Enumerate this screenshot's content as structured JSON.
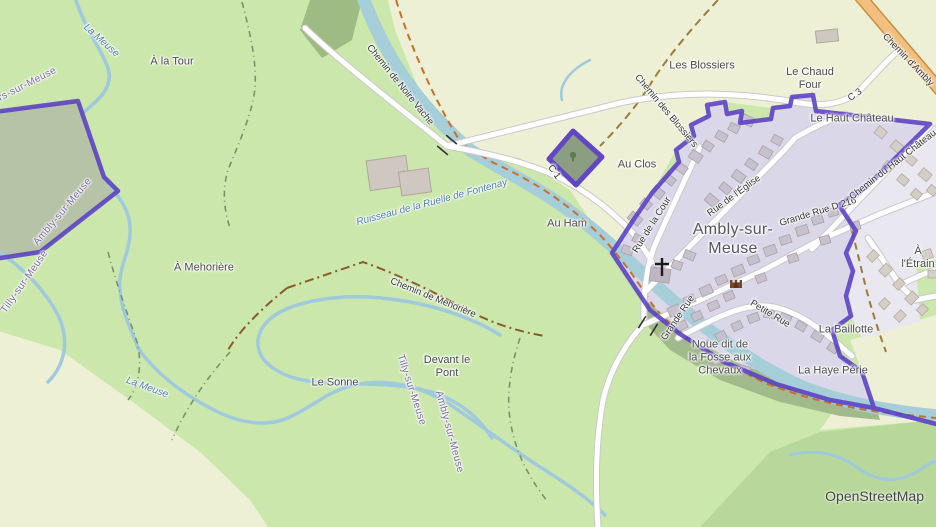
{
  "map": {
    "attribution": "OpenStreetMap",
    "place_labels": {
      "les_blossiers": "Les Blossiers",
      "le_chaud_four": "Le Chaud\nFour",
      "le_haut_chateau": "Le Haut Château",
      "au_clos": "Au Clos",
      "au_ham": "Au Ham",
      "a_la_tour": "À la Tour",
      "a_mehoriere": "À Mehorière",
      "devant_le_pont": "Devant le\nPont",
      "le_sonne": "Le Sonne",
      "la_baillotte": "La Baillotte",
      "la_haye_perie": "La Haye Périe",
      "noue_fosse_chevaux": "Noue dit de\nla Fosse aux\nChevaux",
      "a_l_etrain": "À l'Étrain",
      "village_name": "Ambly-sur-\nMeuse"
    },
    "road_labels": {
      "chemin_de_noire_vache": "Chemin de Noire Vache",
      "chemin_des_blossiers": "Chemin des Blossiers",
      "chemin_d_ambly": "Chemin d'Ambly",
      "c3": "C 3",
      "c1": "C 1",
      "rue_de_la_cour": "Rue de la Cour",
      "rue_de_l_eglise": "Rue de l'Église",
      "grande_rue_d216": "Grande Rue D 216",
      "grande_rue": "Grande Rue",
      "chemin_du_haut_chateau": "Chemin du Haut Château",
      "petite_rue": "Petite Rue",
      "chemin_de_mehoriere": "Chemin de Mehorière"
    },
    "water_labels": {
      "la_meuse_upper": "La Meuse",
      "la_meuse_lower": "La Meuse",
      "ruisseau_fontenay": "Ruisseau de la Ruelle de Fontenay"
    },
    "boundary_labels": {
      "villers_sur_meuse_clipped": "ers-sur-Meuse",
      "ambly_sur_meuse_west": "Ambly-sur-Meuse",
      "tilly_sur_meuse_west": "Tilly-sur-Meuse",
      "tilly_sur_meuse_river": "Tilly-sur-Meuse",
      "ambly_sur_meuse_river": "Ambly-sur-Meuse"
    },
    "icons": {
      "church_icon": "✝",
      "landmark_icon": "castle-brown",
      "tree_icon": "tree-green",
      "bridge_icon": "bridge-ticks"
    },
    "colors": {
      "boundary_purple": "#5a3fc4",
      "water": "#a5ced9",
      "grass": "#cbe7ac",
      "farmland": "#eef0d5",
      "forest": "#b7d79b",
      "residential_inside": "#dad7e8",
      "residential_outside": "#e9e7ef",
      "building": "#c7c1ce",
      "road_orange": "#f1c07f",
      "road_white": "#ffffff",
      "track_brown": "#9c7a3c",
      "path_orange": "#c96f2a"
    }
  }
}
